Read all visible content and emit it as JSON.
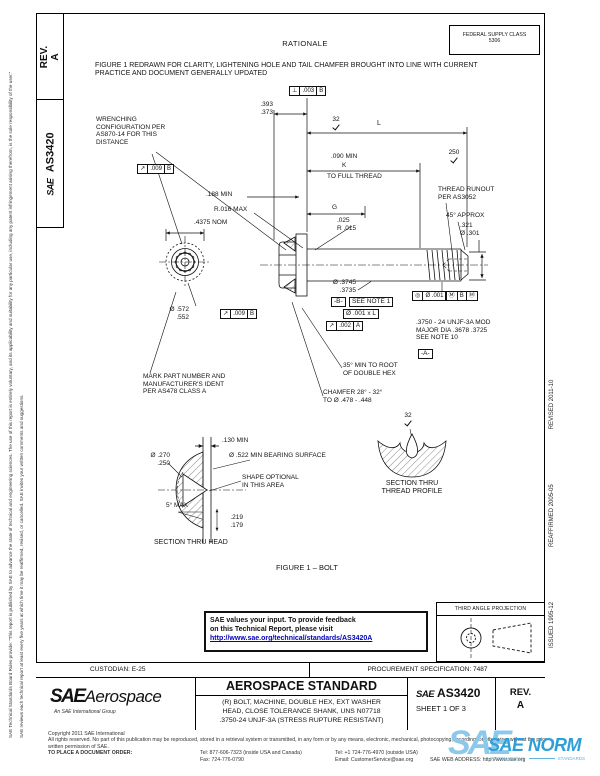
{
  "colors": {
    "link_blue": "#0000bb",
    "watermark_blue": "#2e9fd6",
    "watermark_light_blue": "#8cc8ea"
  },
  "sidebar": {
    "rev": "REV.\nA",
    "sae": "SAE",
    "doc": "AS3420"
  },
  "margins": {
    "disclaimer1": "SAE Technical Standards Board Rules provide: “This report is published by SAE to advance the state of technical and engineering sciences. The use of this report is entirely voluntary, and its applicability and suitability for any particular use, including any patent infringement arising therefrom, is the sole responsibility of the user.”",
    "disclaimer2": "SAE reviews each technical report at least every five years at which time it may be reaffirmed, revised, or cancelled. SAE invites your written comments and suggestions.",
    "issued": "ISSUED 1995-12",
    "reaffirmed": "REAFFIRMED 2005-05",
    "revised": "REVISED 2011-10"
  },
  "header": {
    "rationale_title": "RATIONALE",
    "fsc": "FEDERAL SUPPLY CLASS\n5306",
    "rationale_text": "FIGURE 1 REDRAWN FOR CLARITY, LIGHTENING HOLE AND TAIL CHAMFER BROUGHT INTO LINE WITH CURRENT\nPRACTICE AND DOCUMENT GENERALLY UPDATED"
  },
  "figure": {
    "title": "FIGURE 1 – BOLT",
    "frames": {
      "perp": {
        "sym": "⊥",
        "val": ".003",
        "datum": "B"
      },
      "runout009": {
        "sym": "↗",
        "val": ".009",
        "datum": "B"
      },
      "runout002": {
        "sym": "↗",
        "val": ".002",
        "datum": "A"
      },
      "conc": {
        "sym": "◎",
        "val": "Ø .001",
        "m1": "Ⓜ",
        "datum": "B",
        "m2": "Ⓜ"
      },
      "pos001": "Ø .001 x L",
      "datum_a": "-A-",
      "datum_b": "-B-"
    },
    "callouts": {
      "dim_393": ".393\n.373",
      "wrenching": "WRENCHING\nCONFIGURATION PER\nAS870-14 FOR THIS\nDISTANCE",
      "finish_32": "32",
      "finish_250": "250",
      "dim_l": "L",
      "dim_090": ".090 MIN",
      "dim_k": "K",
      "to_full_thread": "TO FULL THREAD",
      "thread_runout": "THREAD RUNOUT\nPER AS3052",
      "approx_45": "45° APPROX",
      "dim_321": ".321\nØ .301",
      "dim_g": "G",
      "dim_025": ".025\nR .015",
      "dim_188": ".188 MIN",
      "r_016": "R.016 MAX",
      "nom_4375": ".4375 NOM",
      "dim_572": "Ø .572\n.552",
      "dim_3745": "Ø .3745\n.3735",
      "see_note_1": "SEE NOTE 1",
      "thread_spec": ".3750 - 24 UNJF-3A MOD\nMAJOR DIA .3678  .3725\nSEE NOTE 10",
      "root_35": "35° MIN TO ROOT\nOF DOUBLE HEX",
      "chamfer": "CHAMFER 28° - 32°\nTO Ø .478 - .448",
      "mark_part": "MARK PART NUMBER AND\nMANUFACTURER'S IDENT\nPER AS478 CLASS A",
      "dim_130": ".130 MIN",
      "dim_270": "Ø .270\n.250",
      "bearing_522": "Ø .522 MIN BEARING SURFACE",
      "shape_optional": "SHAPE OPTIONAL\nIN THIS AREA",
      "max_5": "5° MAX",
      "dim_219": ".219\n.179",
      "section_head": "SECTION THRU HEAD",
      "section_thread": "SECTION THRU\nTHREAD PROFILE"
    }
  },
  "feedback": {
    "line1": "SAE values your input. To provide feedback",
    "line2": "on this Technical Report, please visit",
    "link": "http://www.sae.org/technical/standards/AS3420A"
  },
  "projection": {
    "label": "THIRD ANGLE PROJECTION"
  },
  "titleblock": {
    "custodian": "CUSTODIAN: E-25",
    "procurement": "PROCUREMENT SPECIFICATION: 7487",
    "logo_sae": "SAE",
    "logo_aerospace": "Aerospace",
    "logo_sub": "An SAE International Group",
    "standard": "AEROSPACE STANDARD",
    "description": "(R) BOLT, MACHINE, DOUBLE HEX, EXT WASHER\nHEAD, CLOSE TOLERANCE SHANK, UNS N07718\n.3750-24 UNJF-3A (STRESS RUPTURE RESISTANT)",
    "doc_sae": "SAE",
    "doc_number": "AS3420",
    "sheet": "SHEET 1 OF 3",
    "rev_title": "REV.",
    "rev_value": "A"
  },
  "footer": {
    "copyright": "Copyright 2011 SAE International",
    "rights": "All rights reserved. No part of this publication may be reproduced, stored in a retrieval system or transmitted, in any form or by any means, electronic, mechanical, photocopying, recording, or otherwise, without the prior written permission of SAE.",
    "order_label": "TO PLACE A DOCUMENT ORDER:",
    "tel_inside": "Tel: 877-606-7323 (inside USA and Canada)",
    "tel_outside": "Tel: +1 724-776-4970 (outside USA)",
    "fax": "Fax: 724-776-0790",
    "email": "Email: CustomerService@sae.org",
    "web": "SAE WEB ADDRESS: http://www.sae.org"
  },
  "watermark": {
    "sae": "SAE",
    "norm": "SAE NORM",
    "international": "INTERNATIONAL",
    "standards": "STANDARDS"
  }
}
